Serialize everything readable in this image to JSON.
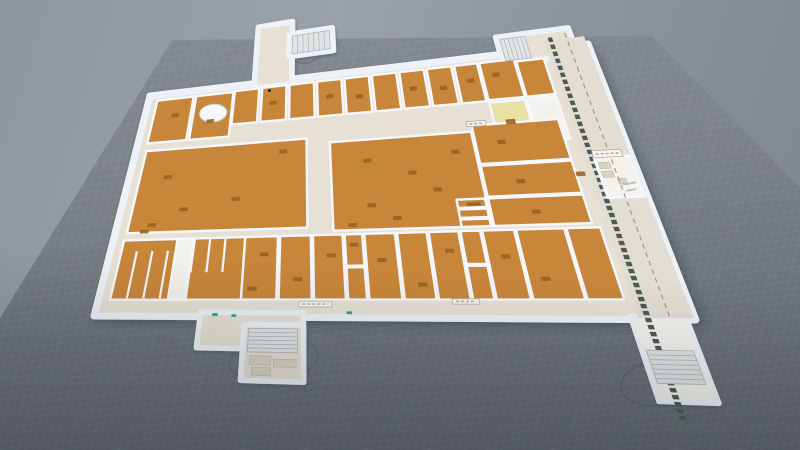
{
  "view": {
    "type": "3d-floorplan-viewport",
    "grid_visible": true
  },
  "colors": {
    "backdrop_a": "#99a1a7",
    "backdrop_b": "#7e868c",
    "ground_a": "#858c92",
    "ground_b": "#60676d",
    "grid_line": "rgba(255,255,255,0.05)",
    "floor_beige": "#e7e1d5",
    "floor_strip": "#e2ded4",
    "floor_orange": "#c8863a",
    "floor_yellow": "#e9e0a4",
    "floor_white": "#f3f2ed",
    "wall": "#f4f7fb",
    "plinth": "#edf2f8",
    "plinth_shadow": "#46525f",
    "furniture": "#96621e",
    "post": "#4d5a54",
    "dash_line": "#8e9494",
    "stair_fill": "#e2e5e4",
    "stair_line": "#aeb6bc",
    "annotation_ring": "rgba(70,80,92,0.38)",
    "chip_bg": "#f5f4ef",
    "chip_line": "#a9a89f",
    "smudge": "#b3b0a6",
    "marker_green": "#2fa08c",
    "fixture": "#d9d3c4",
    "fixture_edge": "#bdb8aa",
    "building_shadow": "rgba(38,46,56,0.28)",
    "desk_fill": "#f5f7f9",
    "desk_stroke": "#c6cfd9",
    "cursor": "#1c1e20"
  },
  "plan": {
    "bounds": {
      "w": 1000,
      "h": 620
    },
    "corners": {
      "c00": [
        150,
        96
      ],
      "c10": [
        588,
        44
      ],
      "c01": [
        94,
        316
      ],
      "c11": [
        696,
        320
      ]
    },
    "strip_bg": [
      905,
      -18,
      93,
      634
    ],
    "wings": [
      [
        238,
        -150,
        86,
        162,
        "b"
      ],
      [
        316,
        -118,
        106,
        58,
        "b"
      ],
      [
        800,
        -40,
        170,
        62,
        "b"
      ],
      [
        176,
        608,
        172,
        96,
        "b"
      ],
      [
        250,
        640,
        98,
        148,
        "b"
      ],
      [
        893,
        612,
        92,
        196,
        "w"
      ]
    ],
    "rooms": [
      [
        20,
        16,
        82,
        120,
        "o"
      ],
      [
        108,
        16,
        84,
        120,
        "o"
      ],
      [
        195,
        14,
        55,
        90,
        "o"
      ],
      [
        257,
        14,
        55,
        90,
        "o"
      ],
      [
        319,
        14,
        55,
        90,
        "o"
      ],
      [
        381,
        14,
        55,
        90,
        "o"
      ],
      [
        443,
        14,
        55,
        90,
        "o"
      ],
      [
        505,
        14,
        55,
        90,
        "o"
      ],
      [
        567,
        14,
        55,
        90,
        "o"
      ],
      [
        629,
        14,
        55,
        90,
        "o"
      ],
      [
        691,
        14,
        52,
        90,
        "o"
      ],
      [
        748,
        14,
        78,
        88,
        "o"
      ],
      [
        830,
        20,
        62,
        82,
        "o"
      ],
      [
        748,
        108,
        76,
        97,
        "y"
      ],
      [
        828,
        108,
        64,
        97,
        "w"
      ],
      [
        22,
        158,
        334,
        230,
        "o"
      ],
      [
        404,
        172,
        292,
        226,
        "o"
      ],
      [
        700,
        158,
        180,
        92,
        "o"
      ],
      [
        700,
        254,
        180,
        74,
        "o"
      ],
      [
        700,
        332,
        180,
        66,
        "o"
      ],
      [
        640,
        332,
        54,
        20,
        "o"
      ],
      [
        640,
        356,
        54,
        20,
        "o"
      ],
      [
        640,
        380,
        54,
        18,
        "o"
      ],
      [
        20,
        408,
        222,
        166,
        "o"
      ],
      [
        118,
        408,
        30,
        166,
        "w"
      ],
      [
        242,
        408,
        60,
        166,
        "o"
      ],
      [
        306,
        408,
        56,
        166,
        "o"
      ],
      [
        366,
        408,
        54,
        166,
        "o"
      ],
      [
        424,
        408,
        32,
        80,
        "o"
      ],
      [
        424,
        492,
        32,
        82,
        "o"
      ],
      [
        460,
        408,
        56,
        166,
        "o"
      ],
      [
        520,
        408,
        54,
        166,
        "o"
      ],
      [
        578,
        408,
        54,
        166,
        "o"
      ],
      [
        636,
        408,
        36,
        80,
        "o"
      ],
      [
        636,
        492,
        36,
        82,
        "o"
      ],
      [
        676,
        408,
        58,
        166,
        "o"
      ],
      [
        738,
        408,
        88,
        166,
        "o"
      ],
      [
        830,
        408,
        62,
        166,
        "o"
      ],
      [
        925,
        250,
        70,
        92,
        "w"
      ]
    ],
    "stalls": [
      [
        48,
        440,
        48,
        570
      ],
      [
        76,
        440,
        76,
        570
      ],
      [
        104,
        440,
        104,
        570
      ],
      [
        150,
        408,
        150,
        500
      ],
      [
        178,
        408,
        178,
        500
      ],
      [
        206,
        408,
        206,
        500
      ]
    ],
    "stairs": [
      [
        324,
        -112,
        90,
        46,
        "v",
        7
      ],
      [
        808,
        -34,
        58,
        50,
        "v",
        6
      ],
      [
        258,
        650,
        80,
        62,
        "h",
        6
      ],
      [
        900,
        690,
        76,
        76,
        "h",
        7
      ]
    ],
    "posts": {
      "x": 916,
      "size": 10,
      "step": 16,
      "y0": -24,
      "y1": 848
    },
    "dash_guide": [
      958,
      -30,
      958,
      612
    ],
    "rings": [
      [
        300,
        730,
        70,
        60
      ],
      [
        905,
        765,
        62,
        52
      ],
      [
        352,
        -78,
        48,
        40
      ]
    ],
    "chips": [
      [
        925,
        235,
        58,
        16
      ],
      [
        340,
        578,
        56,
        15
      ],
      [
        600,
        572,
        46,
        13
      ],
      [
        690,
        148,
        40,
        12
      ]
    ],
    "smudges": [
      [
        962,
        314,
        988,
        310
      ],
      [
        964,
        328,
        984,
        325
      ]
    ],
    "marks": [
      [
        196,
        610,
        9,
        8
      ],
      [
        228,
        613,
        8,
        7
      ],
      [
        420,
        604,
        9,
        7
      ]
    ],
    "desk": [
      152,
      68,
      30,
      24
    ],
    "fixtures": [
      [
        930,
        262,
        22,
        14
      ],
      [
        930,
        282,
        22,
        14
      ],
      [
        956,
        300,
        16,
        12
      ],
      [
        262,
        722,
        34,
        24
      ],
      [
        300,
        730,
        36,
        20
      ],
      [
        266,
        752,
        30,
        22
      ]
    ],
    "furniture": [
      [
        275,
        52
      ],
      [
        400,
        50
      ],
      [
        465,
        58
      ],
      [
        585,
        52
      ],
      [
        650,
        58
      ],
      [
        712,
        48
      ],
      [
        770,
        40
      ],
      [
        60,
        58
      ],
      [
        140,
        84
      ],
      [
        772,
        150,
        20,
        12
      ],
      [
        70,
        230
      ],
      [
        112,
        322
      ],
      [
        58,
        362
      ],
      [
        210,
        300
      ],
      [
        300,
        182
      ],
      [
        46,
        380
      ],
      [
        470,
        220
      ],
      [
        556,
        256
      ],
      [
        470,
        332
      ],
      [
        600,
        300
      ],
      [
        516,
        366
      ],
      [
        432,
        380
      ],
      [
        648,
        212
      ],
      [
        745,
        196
      ],
      [
        762,
        290
      ],
      [
        776,
        362
      ],
      [
        270,
        450
      ],
      [
        330,
        516
      ],
      [
        390,
        456
      ],
      [
        480,
        470
      ],
      [
        546,
        532
      ],
      [
        602,
        450
      ],
      [
        700,
        466
      ],
      [
        760,
        520
      ],
      [
        252,
        540
      ],
      [
        432,
        430
      ],
      [
        658,
        340,
        26,
        8
      ],
      [
        880,
        280,
        18,
        10
      ]
    ]
  },
  "cursor": {
    "x": 268,
    "y": 89
  }
}
